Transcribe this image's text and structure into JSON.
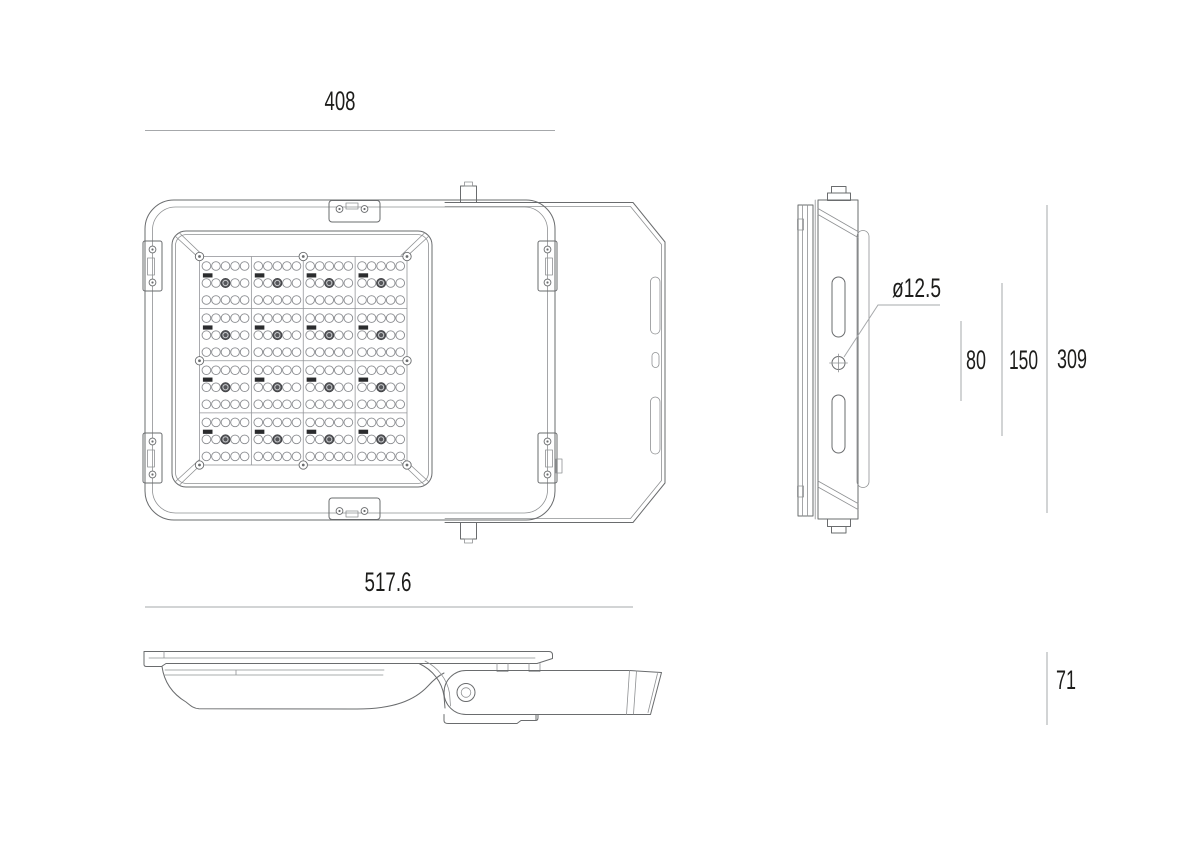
{
  "drawing": {
    "colors": {
      "background": "#ffffff",
      "outline": "#6a6c6e",
      "dimension_line": "#a6a8ab",
      "text": "#1d1d1b",
      "led_dark": "#55565a"
    },
    "dimensions": {
      "front_width": "408",
      "overall_length": "517.6",
      "mount_hole_diameter": "ø12.5",
      "hole_spacing_inner": "80",
      "hole_spacing_outer": "150",
      "body_height": "309",
      "profile_height": "71"
    },
    "led_grid": {
      "rows": 4,
      "cols": 4,
      "led_rows_per_module": 3,
      "leds_per_row": 5
    }
  }
}
